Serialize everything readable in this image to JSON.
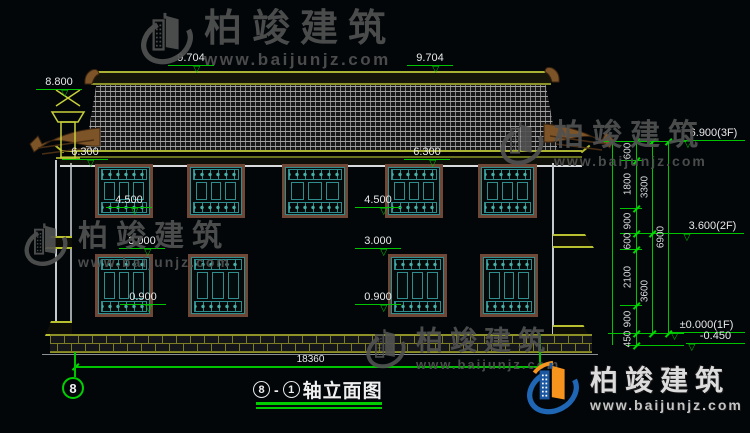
{
  "drawing": {
    "axis_start": "8",
    "axis_end": "1",
    "dash": "-",
    "title": "轴立面图",
    "axis_bubble": "8"
  },
  "levels": {
    "v8800": "8.800",
    "v9704": "9.704",
    "v6300": "6.300",
    "v4500": "4.500",
    "v3000": "3.000",
    "v0900": "0.900",
    "v6900_3f": "6.900(3F)",
    "v3600_2f": "3.600(2F)",
    "v0000_1f": "±0.000(1F)",
    "vm0450": "-0.450"
  },
  "dimensions": {
    "total_width": "18360",
    "d600": "600",
    "d1800": "1800",
    "d900": "900",
    "d2100": "2100",
    "d450": "450",
    "d3300": "3300",
    "d3600": "3600",
    "d6900": "6900"
  },
  "watermark": {
    "name": "柏竣建筑",
    "url": "www.baijunjz.com"
  },
  "colors": {
    "cad_green": "#00c400",
    "cad_yellow": "#a9b232",
    "frame_brown": "#6e4737",
    "lattice_teal": "#2f8d8d",
    "brand_blue": "#1f66b5",
    "brand_orange": "#f7941d"
  }
}
